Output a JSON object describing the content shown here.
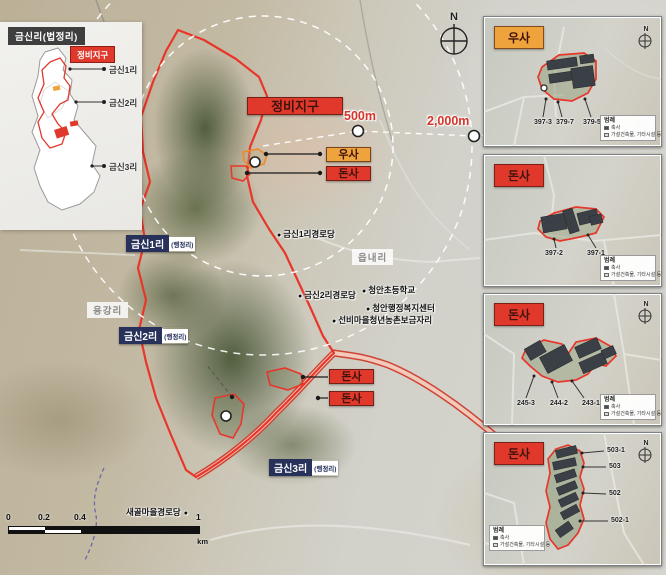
{
  "inset": {
    "title": "금신리(법정리)",
    "district_label": "정비지구",
    "villages": [
      "금신1리",
      "금신2리",
      "금신3리"
    ]
  },
  "main": {
    "district_label": "정비지구",
    "rings": {
      "r500": "500m",
      "r2000": "2,000m"
    },
    "callouts": {
      "usa": "우사",
      "donsa": "돈사"
    },
    "admin": {
      "suffix": "(행정리)",
      "v1": "금신1리",
      "v2": "금신2리",
      "v3": "금신3리"
    },
    "areas": {
      "eupnaeri": "읍내리",
      "yonggangri": "용강리"
    },
    "pois": {
      "senior1": "금신1리경로당",
      "senior2": "금신2리경로당",
      "school": "청안초등학교",
      "admin_center": "청안행정복지센터",
      "seonbi": "선비마을청년농촌보금자리",
      "saegol": "새골마을경로당"
    },
    "bullet": "●",
    "compass_n": "N",
    "scalebar": {
      "t0": "0",
      "t1": "0.2",
      "t2": "0.4",
      "t3": "1",
      "unit": "km"
    }
  },
  "legend": {
    "title": "범례",
    "items": [
      "축사",
      "가설건축물, 기타시설 등"
    ]
  },
  "panels": [
    {
      "title": "우사",
      "parcels": [
        "397-3",
        "379-7",
        "379-5"
      ]
    },
    {
      "title": "돈사",
      "parcels": [
        "397-2",
        "397-1"
      ]
    },
    {
      "title": "돈사",
      "parcels": [
        "245-3",
        "244-2",
        "243-1"
      ]
    },
    {
      "title": "돈사",
      "parcels": [
        "503-1",
        "503",
        "502",
        "502-1"
      ]
    }
  ],
  "colors": {
    "district_red": "#e0392c",
    "barn_orange": "#efa33d",
    "admin_navy": "#27315a",
    "ring_red": "#d6352b"
  }
}
